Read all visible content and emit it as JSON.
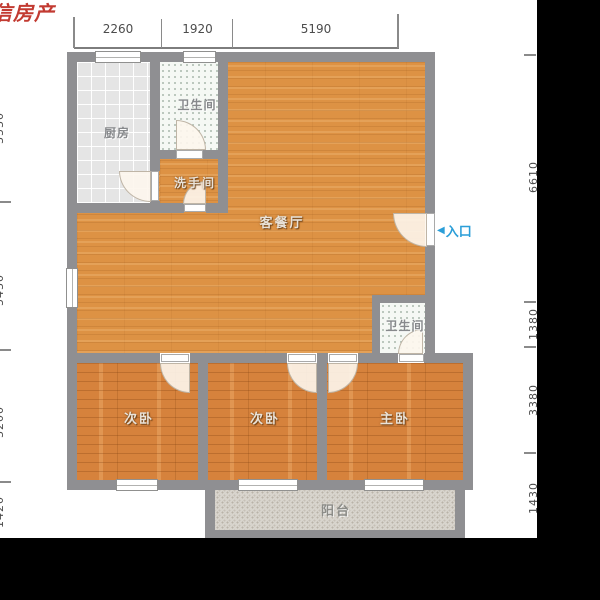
{
  "watermark": {
    "text": "信房产",
    "color": "#c23a31"
  },
  "dimensions": {
    "top": [
      "2260",
      "1920",
      "5190"
    ],
    "left": [
      "3530",
      "5430",
      "3200",
      "1420"
    ],
    "right": [
      "6610",
      "1380",
      "3380",
      "1430"
    ]
  },
  "entry": {
    "arrow": "◀",
    "label": "入口",
    "color": "#2b9ed8"
  },
  "rooms": {
    "kitchen": {
      "label": "厨房"
    },
    "bathroom_top": {
      "label": "卫生间"
    },
    "washroom": {
      "label": "洗手间"
    },
    "living_dining": {
      "label": "客餐厅"
    },
    "bathroom_right": {
      "label": "卫生间"
    },
    "bedroom_left": {
      "label": "次卧"
    },
    "bedroom_middle": {
      "label": "次卧"
    },
    "master_bedroom": {
      "label": "主卧"
    },
    "balcony": {
      "label": "阳台"
    }
  },
  "colors": {
    "wall": "#8f8f92",
    "living_floor": "#dd9244",
    "bedroom_floor": "#d6823c",
    "kitchen_tile": "#e5e5e5",
    "bath_tile": "#f5f8f4",
    "balcony_tile": "#d8d4cd",
    "dimension_text": "#4c4c4c",
    "watermark_red": "#c23a31",
    "entry_blue": "#2b9ed8",
    "matte_black": "#000000"
  }
}
